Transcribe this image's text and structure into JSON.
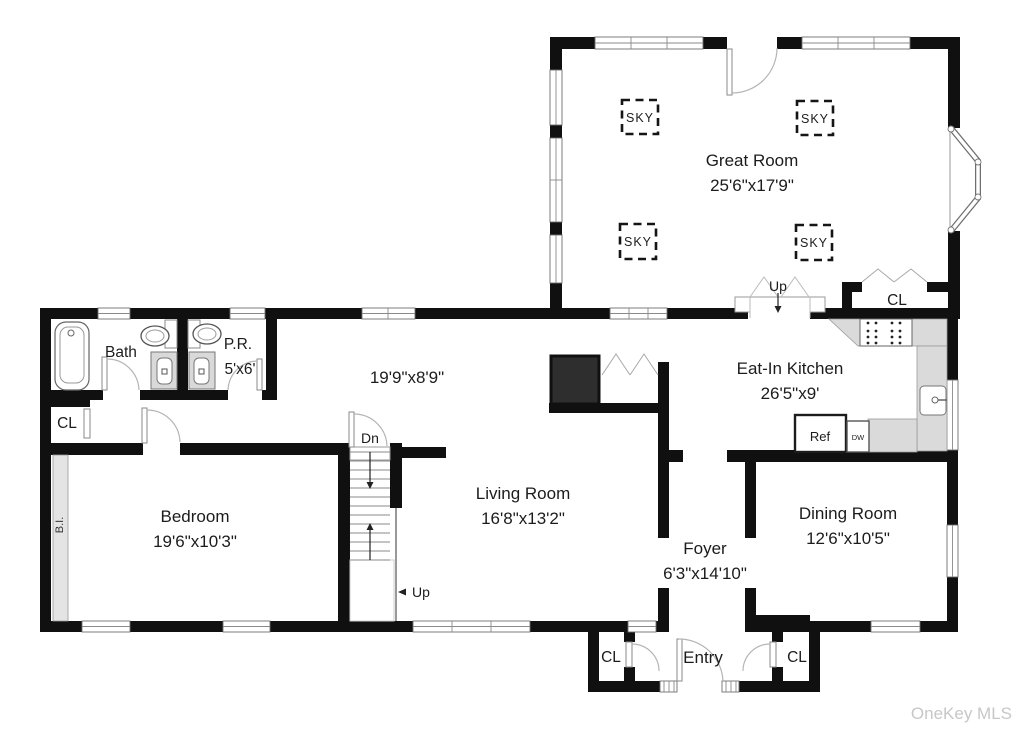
{
  "watermark": "OneKey MLS",
  "colors": {
    "wall": "#101010",
    "counter": "#dadada",
    "fireplace": "#2e2e2e",
    "built_in_strip": "#e4e4e4",
    "watermark_text": "#c7c7c7",
    "label_text": "#1c1c1c"
  },
  "rooms": {
    "great_room": {
      "name": "Great Room",
      "dims": "25'6\"x17'9\""
    },
    "eat_in_kitchen": {
      "name": "Eat-In Kitchen",
      "dims": "26'5\"x9'"
    },
    "living_room": {
      "name": "Living Room",
      "dims": "16'8\"x13'2\""
    },
    "dining_room": {
      "name": "Dining Room",
      "dims": "12'6\"x10'5\""
    },
    "bedroom": {
      "name": "Bedroom",
      "dims": "19'6\"x10'3\""
    },
    "foyer": {
      "name": "Foyer",
      "dims": "6'3\"x14'10\""
    },
    "entry": {
      "name": "Entry"
    },
    "bath": {
      "name": "Bath"
    },
    "powder_room": {
      "name": "P.R.",
      "dims": "5'x6'"
    },
    "hall": {
      "dims": "19'9\"x8'9\""
    }
  },
  "labels": {
    "skylight": "SKY",
    "closet": "CL",
    "up": "Up",
    "down": "Dn",
    "refrigerator": "Ref",
    "dishwasher": "DW",
    "built_in": "B.I."
  }
}
